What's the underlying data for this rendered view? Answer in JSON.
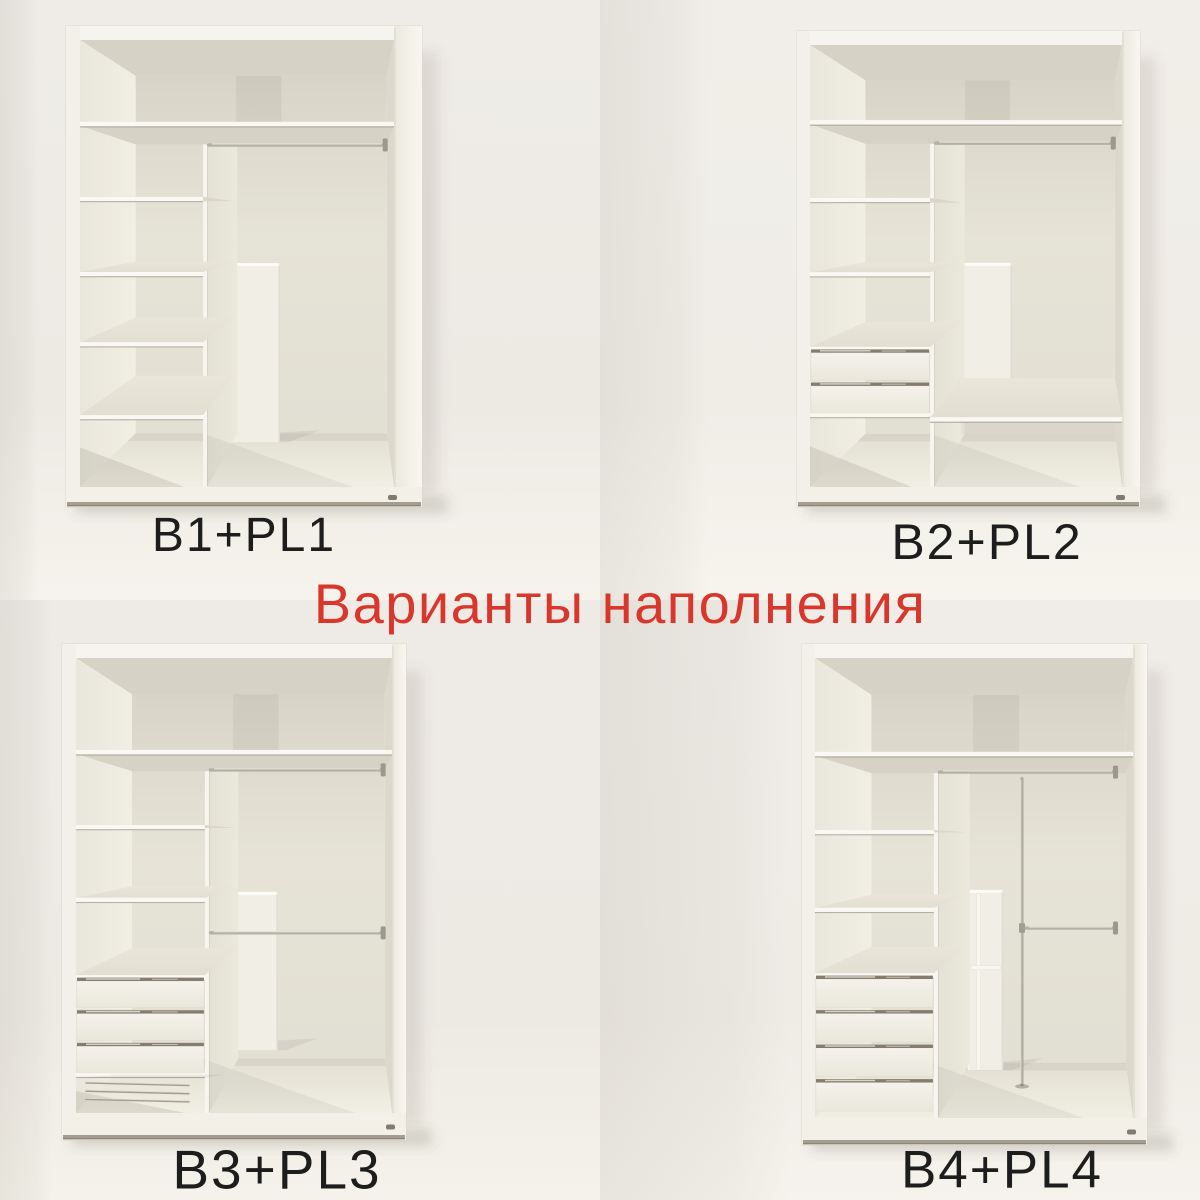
{
  "image_title": {
    "text": "Варианты наполнения",
    "color": "#d9372c",
    "x": 620,
    "y": 604,
    "size": 56
  },
  "label_color": "#1d1d1d",
  "variants": [
    {
      "id": "b1",
      "label": "B1+PL1",
      "label_pos": {
        "x": 244,
        "y": 536,
        "size": 48
      },
      "geometry": {
        "outer": [
          66,
          26,
          422,
          507
        ],
        "interior": [
          80,
          40,
          394,
          487
        ],
        "top_shelf": 0.183,
        "divider": 0.392,
        "shelves": [
          0.351,
          0.519,
          0.676,
          0.839
        ],
        "drawers": null,
        "trouser_rack": null,
        "rods": [
          {
            "y": 0.235,
            "x0": 0.4,
            "x1": 0.972
          }
        ],
        "panel": {
          "x0": 0.42,
          "x1": 0.637,
          "y0": 0.499,
          "y1": 0.9,
          "framed": false
        },
        "low_shelf": null,
        "pole": null
      }
    },
    {
      "id": "b2",
      "label": "B2+PL2",
      "label_pos": {
        "x": 387,
        "y": 542,
        "size": 50
      },
      "geometry": {
        "outer": [
          197,
          31,
          540,
          507
        ],
        "interior": [
          210,
          45,
          522,
          487
        ],
        "top_shelf": 0.17,
        "divider": 0.385,
        "shelves": [
          0.346,
          0.514
        ],
        "drawers": {
          "top": 0.683,
          "bottom": 0.833,
          "count": 2
        },
        "trouser_rack": null,
        "rods": [
          {
            "y": 0.222,
            "x0": 0.393,
            "x1": 0.972
          }
        ],
        "panel": {
          "x0": 0.423,
          "x1": 0.647,
          "y0": 0.493,
          "y1": 0.842,
          "framed": false
        },
        "low_shelf": {
          "y": 0.842
        },
        "pole": null
      }
    },
    {
      "id": "b3",
      "label": "B3+PL3",
      "label_pos": {
        "x": 277,
        "y": 570,
        "size": 55
      },
      "geometry": {
        "outer": [
          62,
          44,
          406,
          540
        ],
        "interior": [
          76,
          58,
          392,
          513
        ],
        "top_shelf": 0.202,
        "divider": 0.408,
        "shelves": [
          0.367,
          0.527
        ],
        "drawers": {
          "top": 0.697,
          "bottom": 0.912,
          "count": 3
        },
        "trouser_rack": {
          "rails": [
            0.934,
            0.952,
            0.97
          ]
        },
        "rods": [
          {
            "y": 0.246,
            "x0": 0.416,
            "x1": 0.972
          },
          {
            "y": 0.604,
            "x0": 0.416,
            "x1": 0.972
          }
        ],
        "panel": {
          "x0": 0.424,
          "x1": 0.639,
          "y0": 0.514,
          "y1": 0.862,
          "framed": false
        },
        "low_shelf": null,
        "pole": null
      }
    },
    {
      "id": "b4",
      "label": "B4+PL4",
      "label_pos": {
        "x": 402,
        "y": 570,
        "size": 53
      },
      "geometry": {
        "outer": [
          202,
          44,
          547,
          545
        ],
        "interior": [
          215,
          58,
          533,
          518
        ],
        "top_shelf": 0.204,
        "divider": 0.374,
        "shelves": [
          0.374,
          0.543
        ],
        "drawers": {
          "top": 0.685,
          "bottom": 0.985,
          "count": 4
        },
        "trouser_rack": null,
        "rods": [
          {
            "y": 0.248,
            "x0": 0.382,
            "x1": 0.945
          },
          {
            "y": 0.587,
            "x0": 0.651,
            "x1": 0.945
          }
        ],
        "panel": {
          "x0": 0.48,
          "x1": 0.592,
          "y0": 0.504,
          "y1": 0.896,
          "framed": true
        },
        "low_shelf": null,
        "pole": {
          "x": 0.651,
          "y0": 0.262,
          "y1": 0.928
        }
      }
    }
  ]
}
